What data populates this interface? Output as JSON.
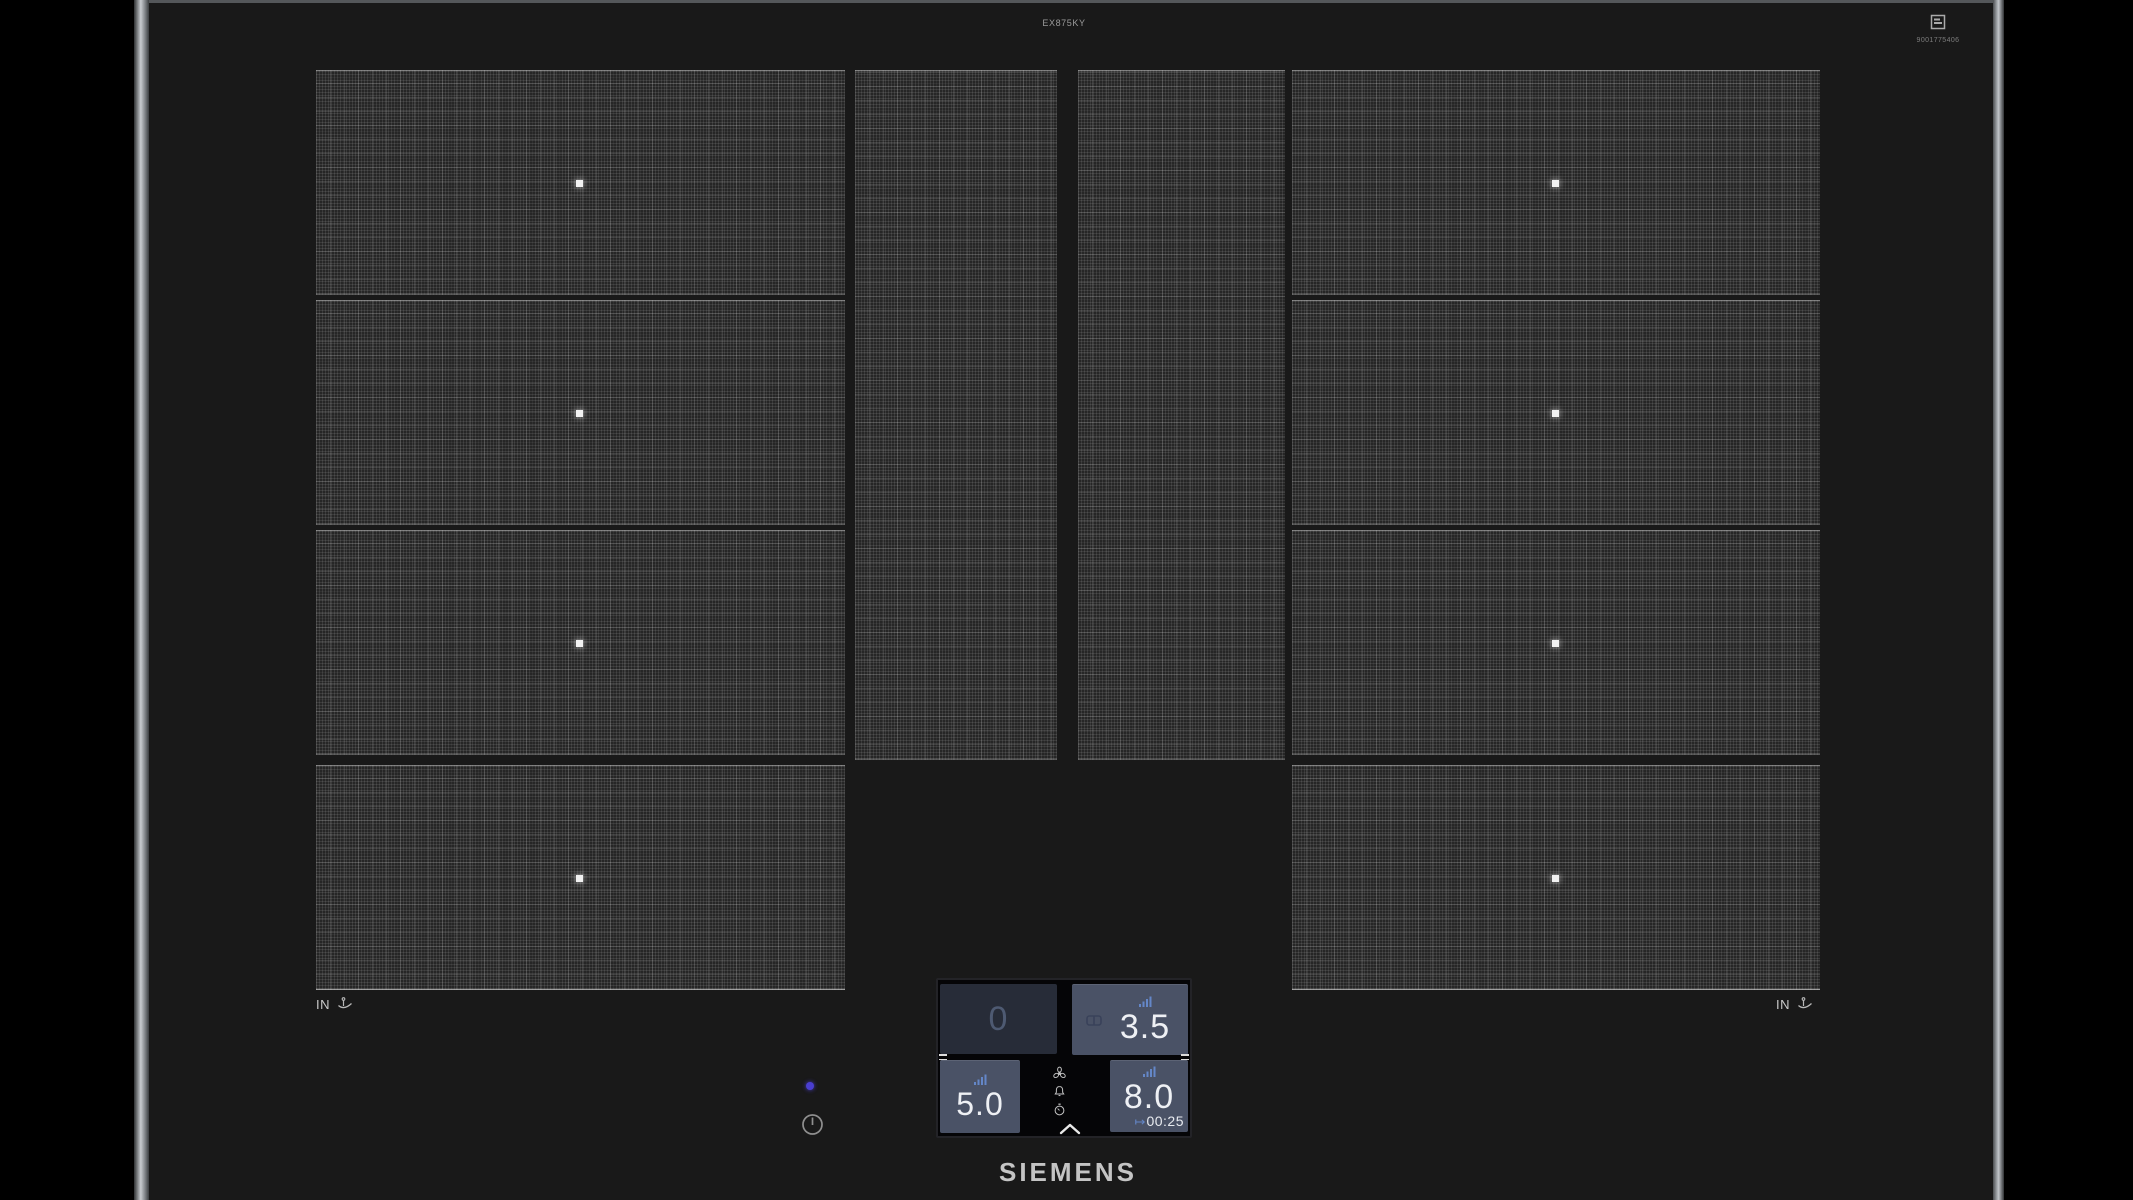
{
  "header": {
    "model": "EX875KY",
    "serial": "9001775406"
  },
  "hob": {
    "pan_left_label": "IN",
    "pan_right_label": "IN",
    "brand": "SIEMENS"
  },
  "panel": {
    "tiles": [
      {
        "name": "zone-front-left",
        "value": "0",
        "state": "inactive"
      },
      {
        "name": "zone-front-right",
        "value": "3.5",
        "state": "active",
        "bridged": true
      },
      {
        "name": "zone-rear-left",
        "value": "5.0",
        "state": "active"
      },
      {
        "name": "zone-rear-right",
        "value": "8.0",
        "state": "active",
        "timer": "00:25"
      }
    ],
    "glyphs": {
      "timer_arrow": "↦"
    }
  },
  "colors": {
    "accent_blue": "#6487c8",
    "tile_active": "#4a5266",
    "tile_inactive": "#272c38",
    "led_indicator": "#4a3ed0",
    "surface": "#191919"
  }
}
